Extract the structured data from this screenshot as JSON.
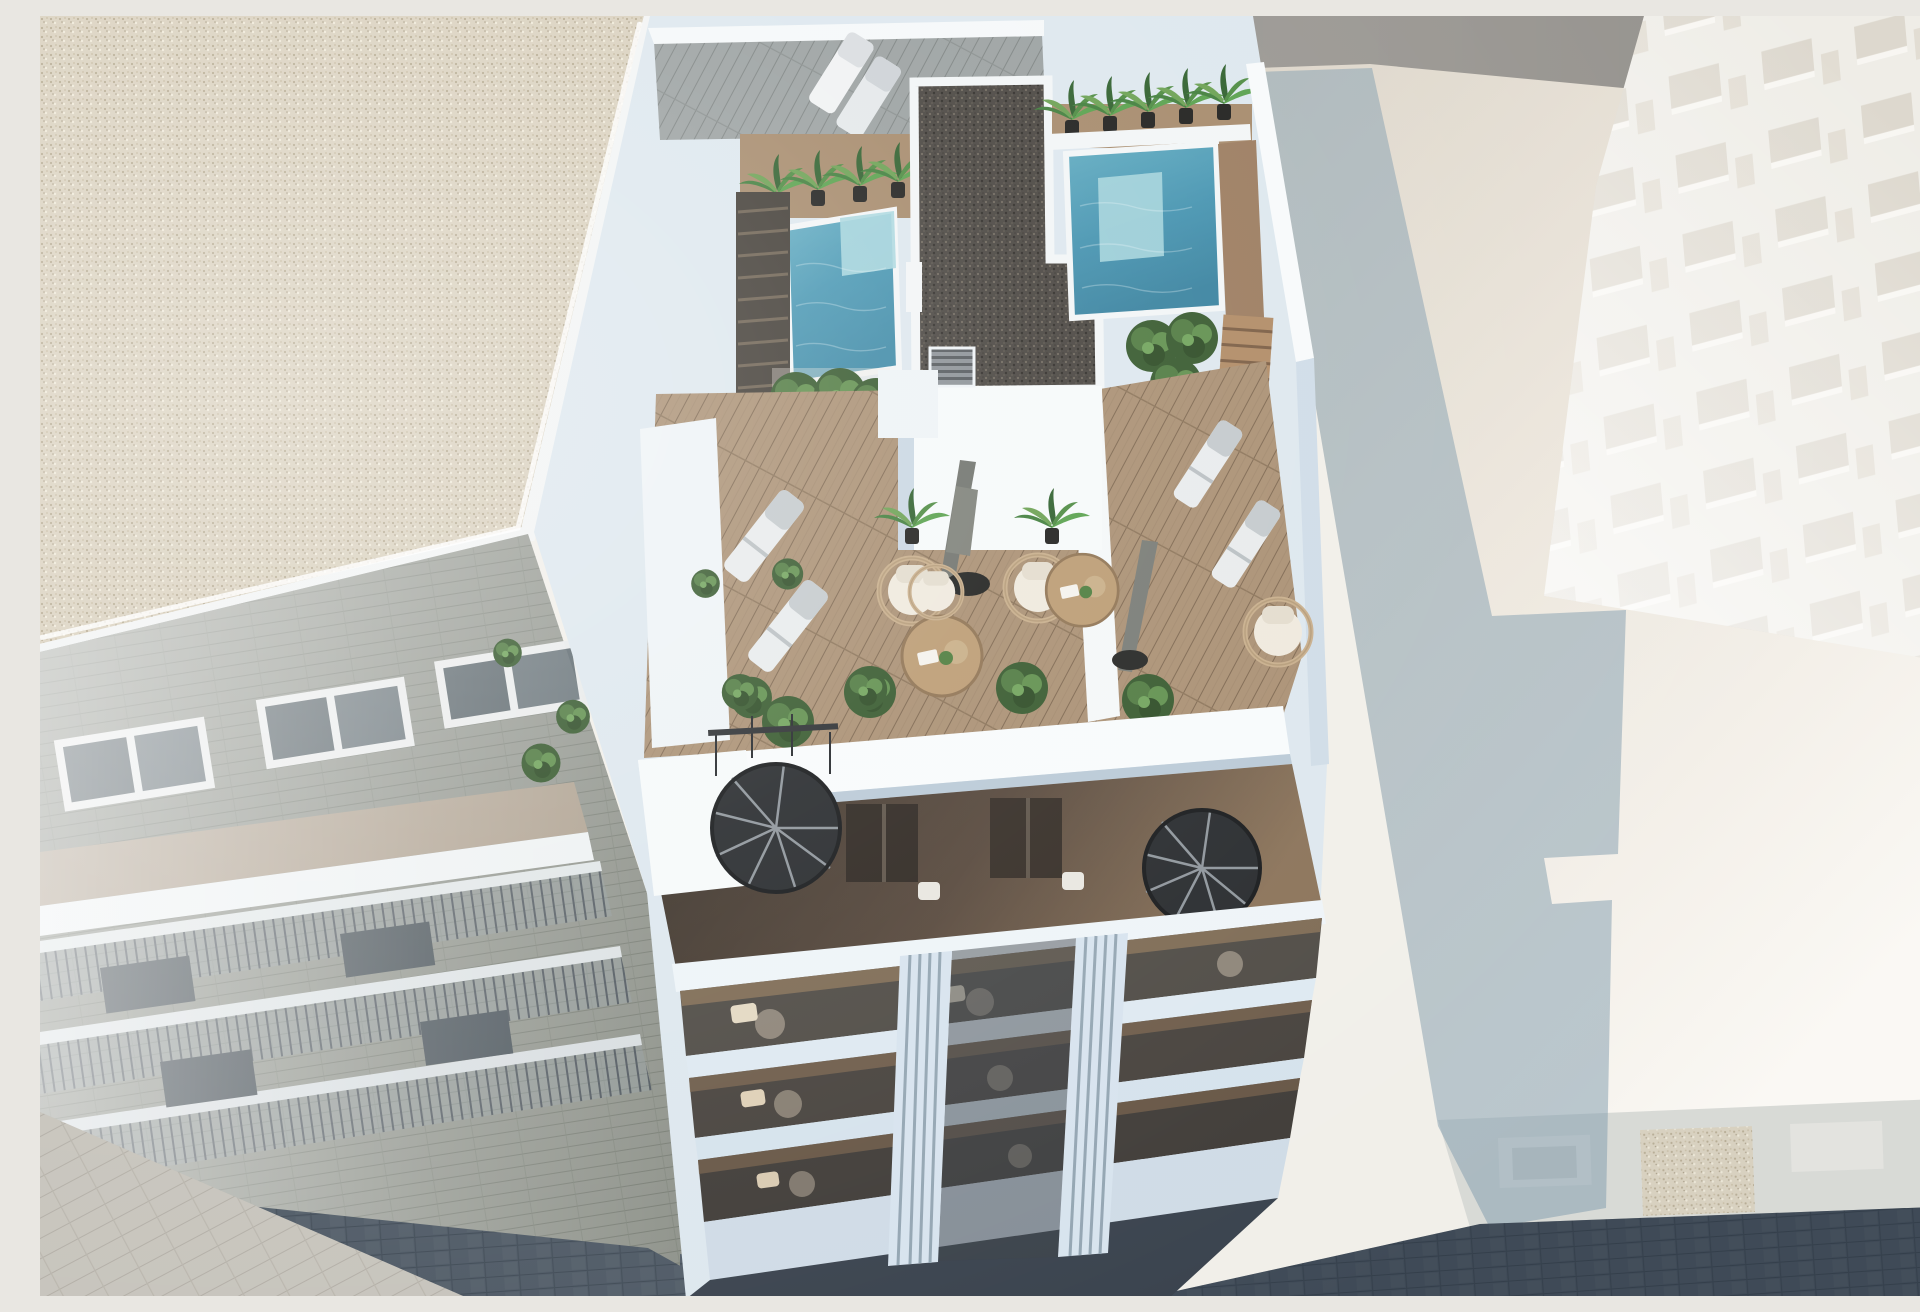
{
  "scene": {
    "type": "architectural-3d-render",
    "view": "aerial-top-down",
    "description": "Aerial 3D rendering of a modern white apartment building rooftop with two turquoise plunge pools, a dark gravel core roof, wooden deck terraces with sun loungers, hanging rattan chairs, closed parasols, round tables and potted palms; lower attic level with two black spiral staircases, a balconied street facade below, a gravel-roofed neighbour building on the left, pale sunlit buildings on the right and a cobbled street at the bottom",
    "inventory": [
      "neighbour-gravel-roof",
      "neighbour-brick-facade-with-windows-and-balconies",
      "rooftop-pool-left",
      "rooftop-pool-right",
      "central-gravel-core-roof",
      "potted-palms",
      "double-sun-lounger-upper-court",
      "sun-loungers-left-terrace",
      "sun-loungers-right-terrace",
      "closed-parasols",
      "hanging-rattan-chairs",
      "round-coffee-tables",
      "green-shrubs",
      "elevator-core-with-louver-vent",
      "spiral-staircase-left",
      "spiral-staircase-right",
      "glass-balustrade-balconies",
      "fluted-white-pillars",
      "cast-building-shadow-on-roof",
      "cobbled-street",
      "sunlit-pavement",
      "far-right-tower-window-grid"
    ],
    "palette": {
      "neighbour_roof_gravel": "#d9d0bd",
      "neighbour_brick": "#8d9189",
      "white_wall_lit": "#f3f6f7",
      "white_wall_shade": "#c9d8e4",
      "pool_deep": "#3d89a6",
      "pool_mid": "#5aa7bd",
      "pool_shallow": "#a7d6de",
      "deck_wood": "#a98f72",
      "deck_wood_dark": "#86674d",
      "gravel_core": "#47433e",
      "plant_green_dark": "#2f5429",
      "plant_green": "#4c7c3c",
      "plant_green_light": "#6aa051",
      "lounger_white": "#e8ebec",
      "parasol_grey": "#6f726c",
      "rattan": "#c7ad8a",
      "table_wood": "#bb9b72",
      "glass_balustrade": "#4a453f",
      "pillar_blue_white": "#d7e3ee",
      "street_cobble": "#4d5864",
      "pavement_light": "#b7b2a8",
      "right_roof_pale": "#ece6dc",
      "cast_shadow_blue": "#7e99ab",
      "background_wall_grey": "#9c9994",
      "background_tan_strip": "#cfa06d",
      "sea_teal_band": "#b4c8ce",
      "far_building_window": "#d7d1c5"
    }
  }
}
